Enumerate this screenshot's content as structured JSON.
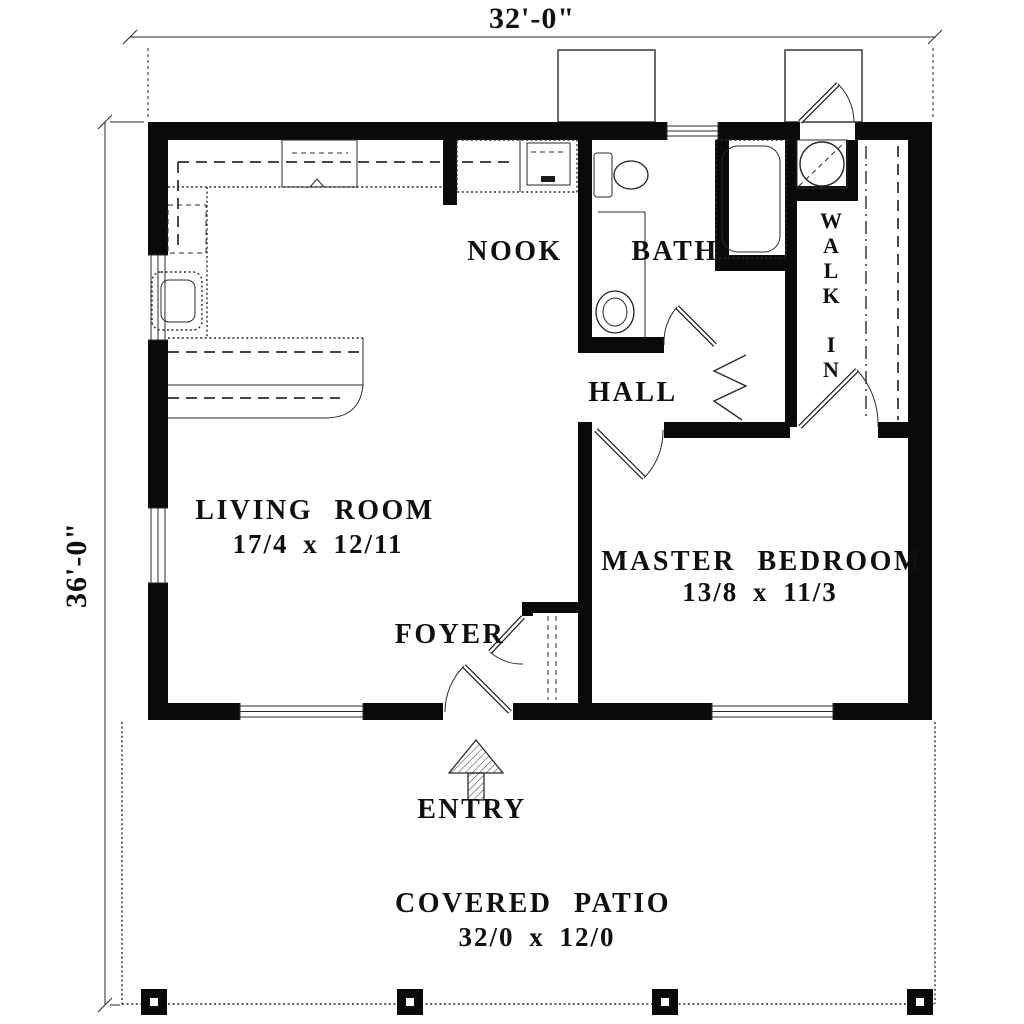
{
  "dimensions": {
    "width": "32'-0\"",
    "height": "36'-0\""
  },
  "rooms": {
    "nook": {
      "label": "NOOK"
    },
    "bath": {
      "label": "BATH"
    },
    "walk_in": {
      "label": "WALK IN"
    },
    "hall": {
      "label": "HALL"
    },
    "living_room": {
      "label": "LIVING ROOM",
      "size": "17/4 x 12/11"
    },
    "master_bedroom": {
      "label": "MASTER BEDROOM",
      "size": "13/8 x 11/3"
    },
    "foyer": {
      "label": "FOYER"
    },
    "covered_patio": {
      "label": "COVERED PATIO",
      "size": "32/0 x 12/0"
    }
  },
  "annotations": {
    "entry_label": "ENTRY"
  },
  "colors": {
    "wall": "#0a0a0a",
    "line": "#2b2b2b",
    "bg": "#ffffff"
  }
}
